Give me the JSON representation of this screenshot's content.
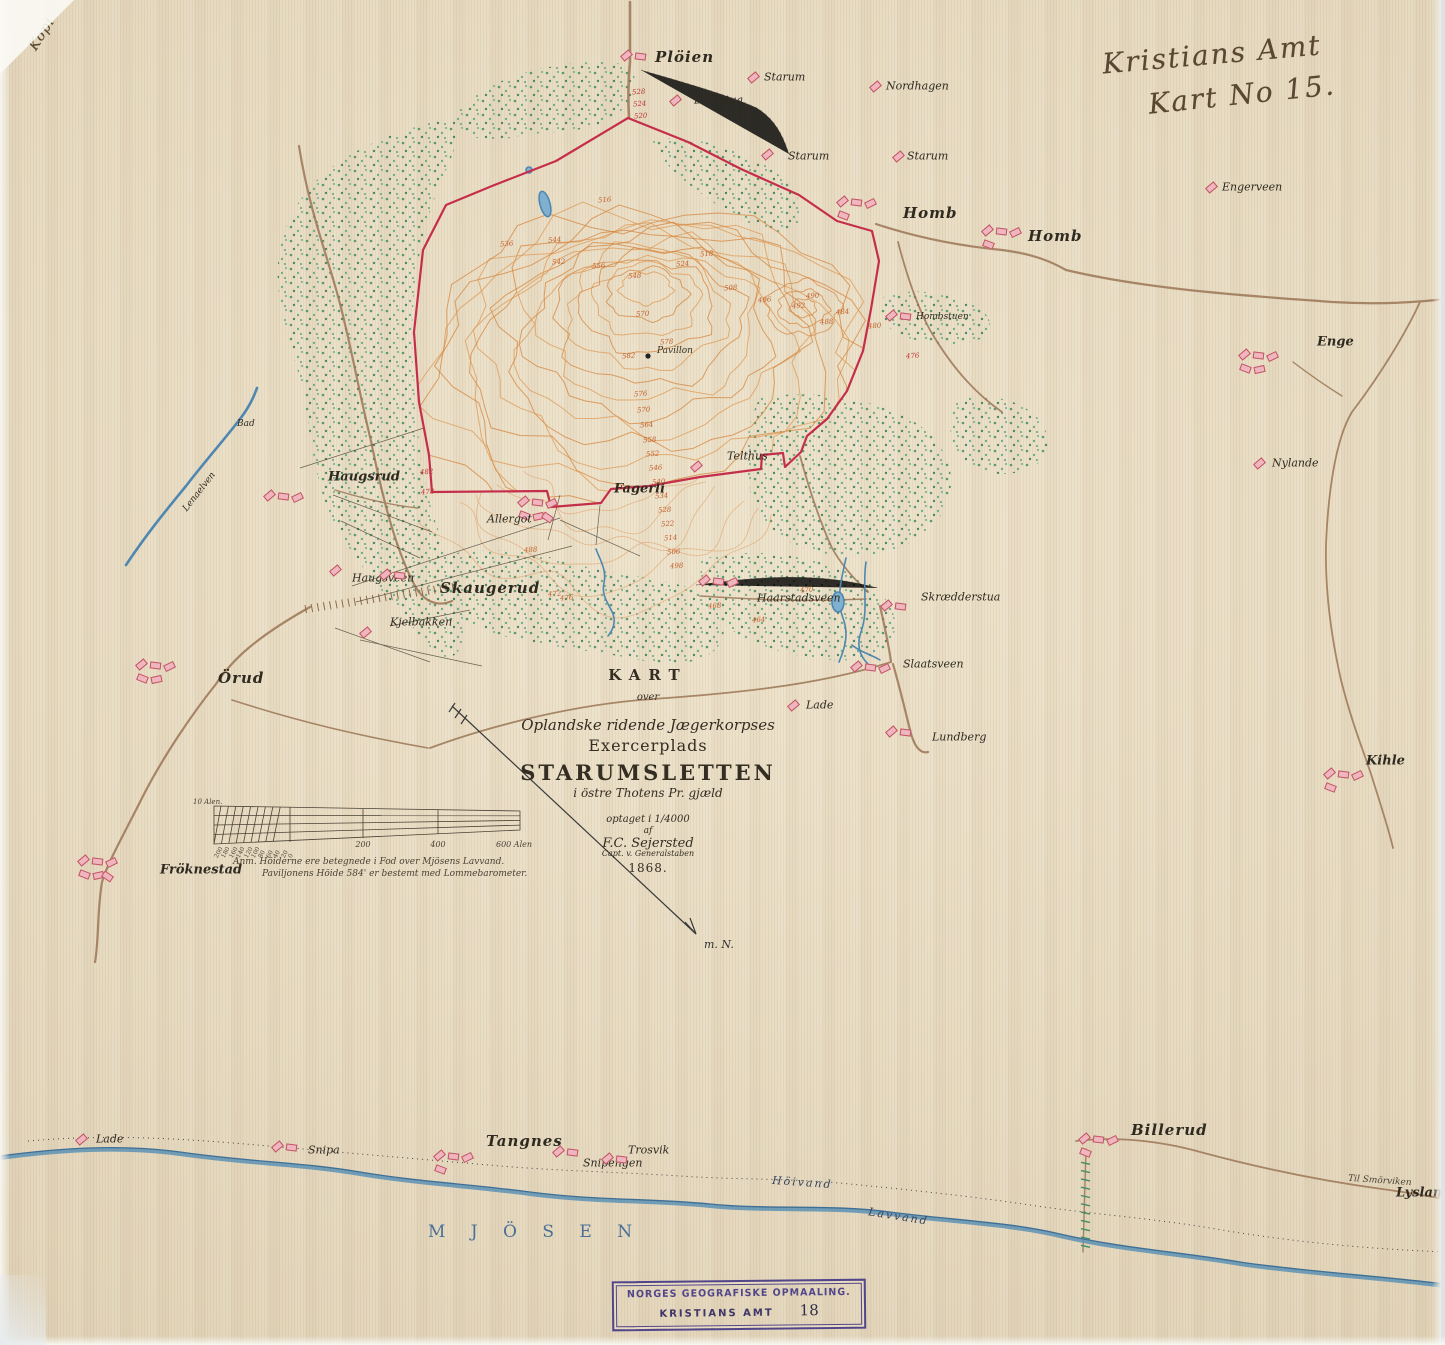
{
  "handwriting": {
    "kopi": "Kopi",
    "corner_line1": "Kristians Amt",
    "corner_line2": "Kart No 15."
  },
  "title_block": {
    "kart": "KART",
    "over": "over",
    "corps": "Oplandske ridende Jægerkorpses",
    "exercerplads": "Exercerplads",
    "name": "STARUMSLETTEN",
    "parish": "i östre Thotens Pr. gjæld",
    "surveyed": "optaget i 1/4000",
    "af": "af",
    "author": "F.C. Sejersted",
    "role": "Capt. v. Generalstaben",
    "year": "1868."
  },
  "notes": {
    "line1": "Anm.  Höiderne ere betegnede i Fod over Mjösens Lavvand.",
    "line2": "Paviljonens Höide 584' er bestemt med Lommebarometer."
  },
  "scale_bar": {
    "unit_label": "10 Alen.",
    "sub_labels": [
      "200",
      "180",
      "160",
      "140",
      "120",
      "100",
      "80",
      "60",
      "40",
      "20",
      "0"
    ],
    "main_labels": [
      "200",
      "400",
      "600 Alen"
    ]
  },
  "north_arrow": {
    "label": "m. N."
  },
  "pavilion": {
    "label": "Pavillon"
  },
  "lake": {
    "name": "M J Ö S E N",
    "high_water": "Höivand",
    "low_water": "Lavvand"
  },
  "stamp": {
    "line1": "NORGES GEOGRAFISKE OPMAALING.",
    "line2": "KRISTIANS AMT",
    "number": "18"
  },
  "road_labels": [
    {
      "t": "Til Smörviken",
      "x": 1348,
      "y": 1176,
      "r": 4
    }
  ],
  "places": [
    {
      "n": "Plöien",
      "x": 655,
      "y": 57,
      "s": "l",
      "b": 2,
      "bx": -34,
      "by": -2
    },
    {
      "n": "Dölestua",
      "x": 694,
      "y": 100,
      "s": "s",
      "b": 1,
      "bx": -24,
      "by": 0
    },
    {
      "n": "Starum",
      "x": 764,
      "y": 77,
      "s": "s",
      "b": 1,
      "bx": -16,
      "by": 0
    },
    {
      "n": "Nordhagen",
      "x": 886,
      "y": 86,
      "s": "s",
      "b": 1,
      "bx": -16,
      "by": 0
    },
    {
      "n": "Starum",
      "x": 788,
      "y": 156,
      "s": "s",
      "b": 1,
      "bx": -26,
      "by": -2
    },
    {
      "n": "Starum",
      "x": 907,
      "y": 156,
      "s": "s",
      "b": 1,
      "bx": -14,
      "by": 0
    },
    {
      "n": "Engerveen",
      "x": 1222,
      "y": 187,
      "s": "s",
      "b": 1,
      "bx": -16,
      "by": 0
    },
    {
      "n": "Homb",
      "x": 903,
      "y": 213,
      "s": "l",
      "b": 4,
      "bx": -66,
      "by": -12
    },
    {
      "n": "Homb",
      "x": 1028,
      "y": 236,
      "s": "l",
      "b": 4,
      "bx": -46,
      "by": -6
    },
    {
      "n": "Hombstuen",
      "x": 916,
      "y": 317,
      "s": "t",
      "b": 2,
      "bx": -30,
      "by": -2
    },
    {
      "n": "Enge",
      "x": 1317,
      "y": 342,
      "s": "m",
      "b": 5,
      "bx": -78,
      "by": 12
    },
    {
      "n": "Nylande",
      "x": 1272,
      "y": 463,
      "s": "s",
      "b": 1,
      "bx": -18,
      "by": 0
    },
    {
      "n": "Telthus",
      "x": 727,
      "y": 456,
      "s": "s",
      "b": 1,
      "bx": -36,
      "by": 10
    },
    {
      "n": "Fagerli",
      "x": 614,
      "y": 489,
      "s": "m",
      "b": 6,
      "bx": -96,
      "by": 12
    },
    {
      "n": "Haugsrud",
      "x": 328,
      "y": 477,
      "s": "m",
      "b": 3,
      "bx": -64,
      "by": 18
    },
    {
      "n": "Allergot",
      "x": 487,
      "y": 519,
      "s": "s",
      "b": 0
    },
    {
      "n": "Haugsveen",
      "x": 352,
      "y": 578,
      "s": "s",
      "b": 1,
      "bx": -22,
      "by": -8
    },
    {
      "n": "Skaugerud",
      "x": 440,
      "y": 588,
      "s": "l",
      "b": 2,
      "bx": -60,
      "by": -14
    },
    {
      "n": "Kjelbakken",
      "x": 390,
      "y": 622,
      "s": "s",
      "b": 1,
      "bx": -30,
      "by": 10
    },
    {
      "n": "Haarstadsveen",
      "x": 757,
      "y": 598,
      "s": "s",
      "b": 3,
      "bx": -58,
      "by": -18
    },
    {
      "n": "Skrædderstua",
      "x": 921,
      "y": 597,
      "s": "s",
      "b": 2,
      "bx": -40,
      "by": 8
    },
    {
      "n": "Slaatsveen",
      "x": 903,
      "y": 664,
      "s": "s",
      "b": 3,
      "bx": -52,
      "by": 2
    },
    {
      "n": "Lade",
      "x": 806,
      "y": 705,
      "s": "s",
      "b": 1,
      "bx": -18,
      "by": 0
    },
    {
      "n": "Lundberg",
      "x": 932,
      "y": 737,
      "s": "s",
      "b": 2,
      "bx": -46,
      "by": -6
    },
    {
      "n": "Örud",
      "x": 218,
      "y": 678,
      "s": "l",
      "b": 5,
      "bx": -82,
      "by": -14
    },
    {
      "n": "Kihle",
      "x": 1366,
      "y": 761,
      "s": "m",
      "b": 4,
      "bx": -42,
      "by": 12
    },
    {
      "n": "Fröknestad",
      "x": 160,
      "y": 870,
      "s": "m",
      "b": 6,
      "bx": -82,
      "by": -10
    },
    {
      "n": "Billerud",
      "x": 1131,
      "y": 1130,
      "s": "l",
      "b": 4,
      "bx": -52,
      "by": 8
    },
    {
      "n": "Lade",
      "x": 96,
      "y": 1139,
      "s": "s",
      "b": 1,
      "bx": -20,
      "by": 0
    },
    {
      "n": "Snipa",
      "x": 308,
      "y": 1150,
      "s": "s",
      "b": 2,
      "bx": -36,
      "by": -4
    },
    {
      "n": "Tangnes",
      "x": 486,
      "y": 1141,
      "s": "l",
      "b": 4,
      "bx": -52,
      "by": 14
    },
    {
      "n": "Snipengen",
      "x": 583,
      "y": 1163,
      "s": "s",
      "b": 2,
      "bx": -30,
      "by": -12
    },
    {
      "n": "Trosvik",
      "x": 628,
      "y": 1150,
      "s": "s",
      "b": 2,
      "bx": -26,
      "by": 8
    },
    {
      "n": "Lysland",
      "x": 1396,
      "y": 1193,
      "s": "m",
      "b": 1,
      "bx": 64,
      "by": 0
    },
    {
      "n": "Bad",
      "x": 237,
      "y": 424,
      "s": "t",
      "b": 0
    },
    {
      "n": "Lenaelven",
      "x": 176,
      "y": 492,
      "s": "t",
      "b": 0,
      "r": -52
    }
  ],
  "elevations": [
    [
      598,
      196,
      "516"
    ],
    [
      552,
      258,
      "542"
    ],
    [
      592,
      262,
      "556"
    ],
    [
      628,
      272,
      "548"
    ],
    [
      676,
      260,
      "524"
    ],
    [
      724,
      284,
      "508"
    ],
    [
      758,
      296,
      "496"
    ],
    [
      792,
      302,
      "492"
    ],
    [
      820,
      318,
      "488"
    ],
    [
      636,
      310,
      "570"
    ],
    [
      660,
      338,
      "578"
    ],
    [
      622,
      352,
      "582"
    ],
    [
      634,
      390,
      "576"
    ],
    [
      637,
      406,
      "570"
    ],
    [
      640,
      421,
      "564"
    ],
    [
      643,
      436,
      "558"
    ],
    [
      646,
      450,
      "552"
    ],
    [
      649,
      464,
      "546"
    ],
    [
      652,
      478,
      "540"
    ],
    [
      655,
      492,
      "534"
    ],
    [
      658,
      506,
      "528"
    ],
    [
      661,
      520,
      "522"
    ],
    [
      664,
      534,
      "514"
    ],
    [
      667,
      548,
      "506"
    ],
    [
      670,
      562,
      "498"
    ],
    [
      560,
      594,
      "476"
    ],
    [
      524,
      546,
      "488"
    ],
    [
      500,
      240,
      "536"
    ],
    [
      548,
      236,
      "544"
    ],
    [
      700,
      250,
      "518"
    ],
    [
      806,
      292,
      "490"
    ],
    [
      836,
      308,
      "484"
    ],
    [
      868,
      322,
      "480"
    ],
    [
      906,
      352,
      "476",
      1
    ],
    [
      548,
      590,
      "472"
    ],
    [
      708,
      602,
      "468"
    ],
    [
      752,
      616,
      "464"
    ],
    [
      800,
      586,
      "470"
    ],
    [
      420,
      468,
      "482",
      1
    ],
    [
      421,
      488,
      "478",
      1
    ],
    [
      632,
      88,
      "528",
      1
    ],
    [
      633,
      100,
      "524",
      1
    ],
    [
      634,
      112,
      "520",
      1
    ]
  ]
}
